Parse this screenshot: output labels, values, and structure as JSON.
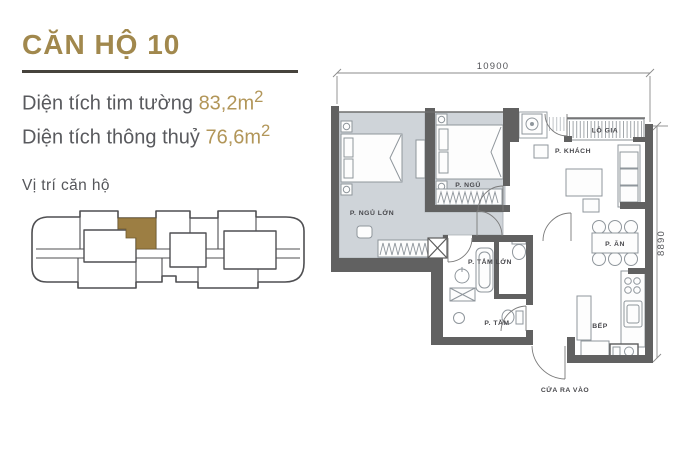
{
  "header": {
    "title": "CĂN HỘ 10"
  },
  "areas": {
    "tim_tuong_label": "Diện tích tim tường ",
    "tim_tuong_value": "83,2m",
    "tim_tuong_sup": "2",
    "thong_thuy_label": "Diện tích thông thuỷ ",
    "thong_thuy_value": "76,6m",
    "thong_thuy_sup": "2"
  },
  "location": {
    "label": "Vị trí căn hộ"
  },
  "plan": {
    "dim_top": "10900",
    "dim_right": "8890",
    "rooms": {
      "master_bedroom": "P. NGỦ LỚN",
      "bedroom": "P. NGỦ",
      "living_room": "P. KHÁCH",
      "loggia": "LÔ GIA",
      "dining": "P. ĂN",
      "master_bathroom": "P. TẮM LỚN",
      "bathroom": "P. TẮM",
      "kitchen": "BẾP",
      "entrance": "CỬA RA VÀO"
    }
  },
  "colors": {
    "title_gold": "#a1884d",
    "value_gold": "#b29659",
    "unit_highlight": "#9c7e43",
    "wall": "#616161",
    "room_floor": "#cfd4d9"
  }
}
